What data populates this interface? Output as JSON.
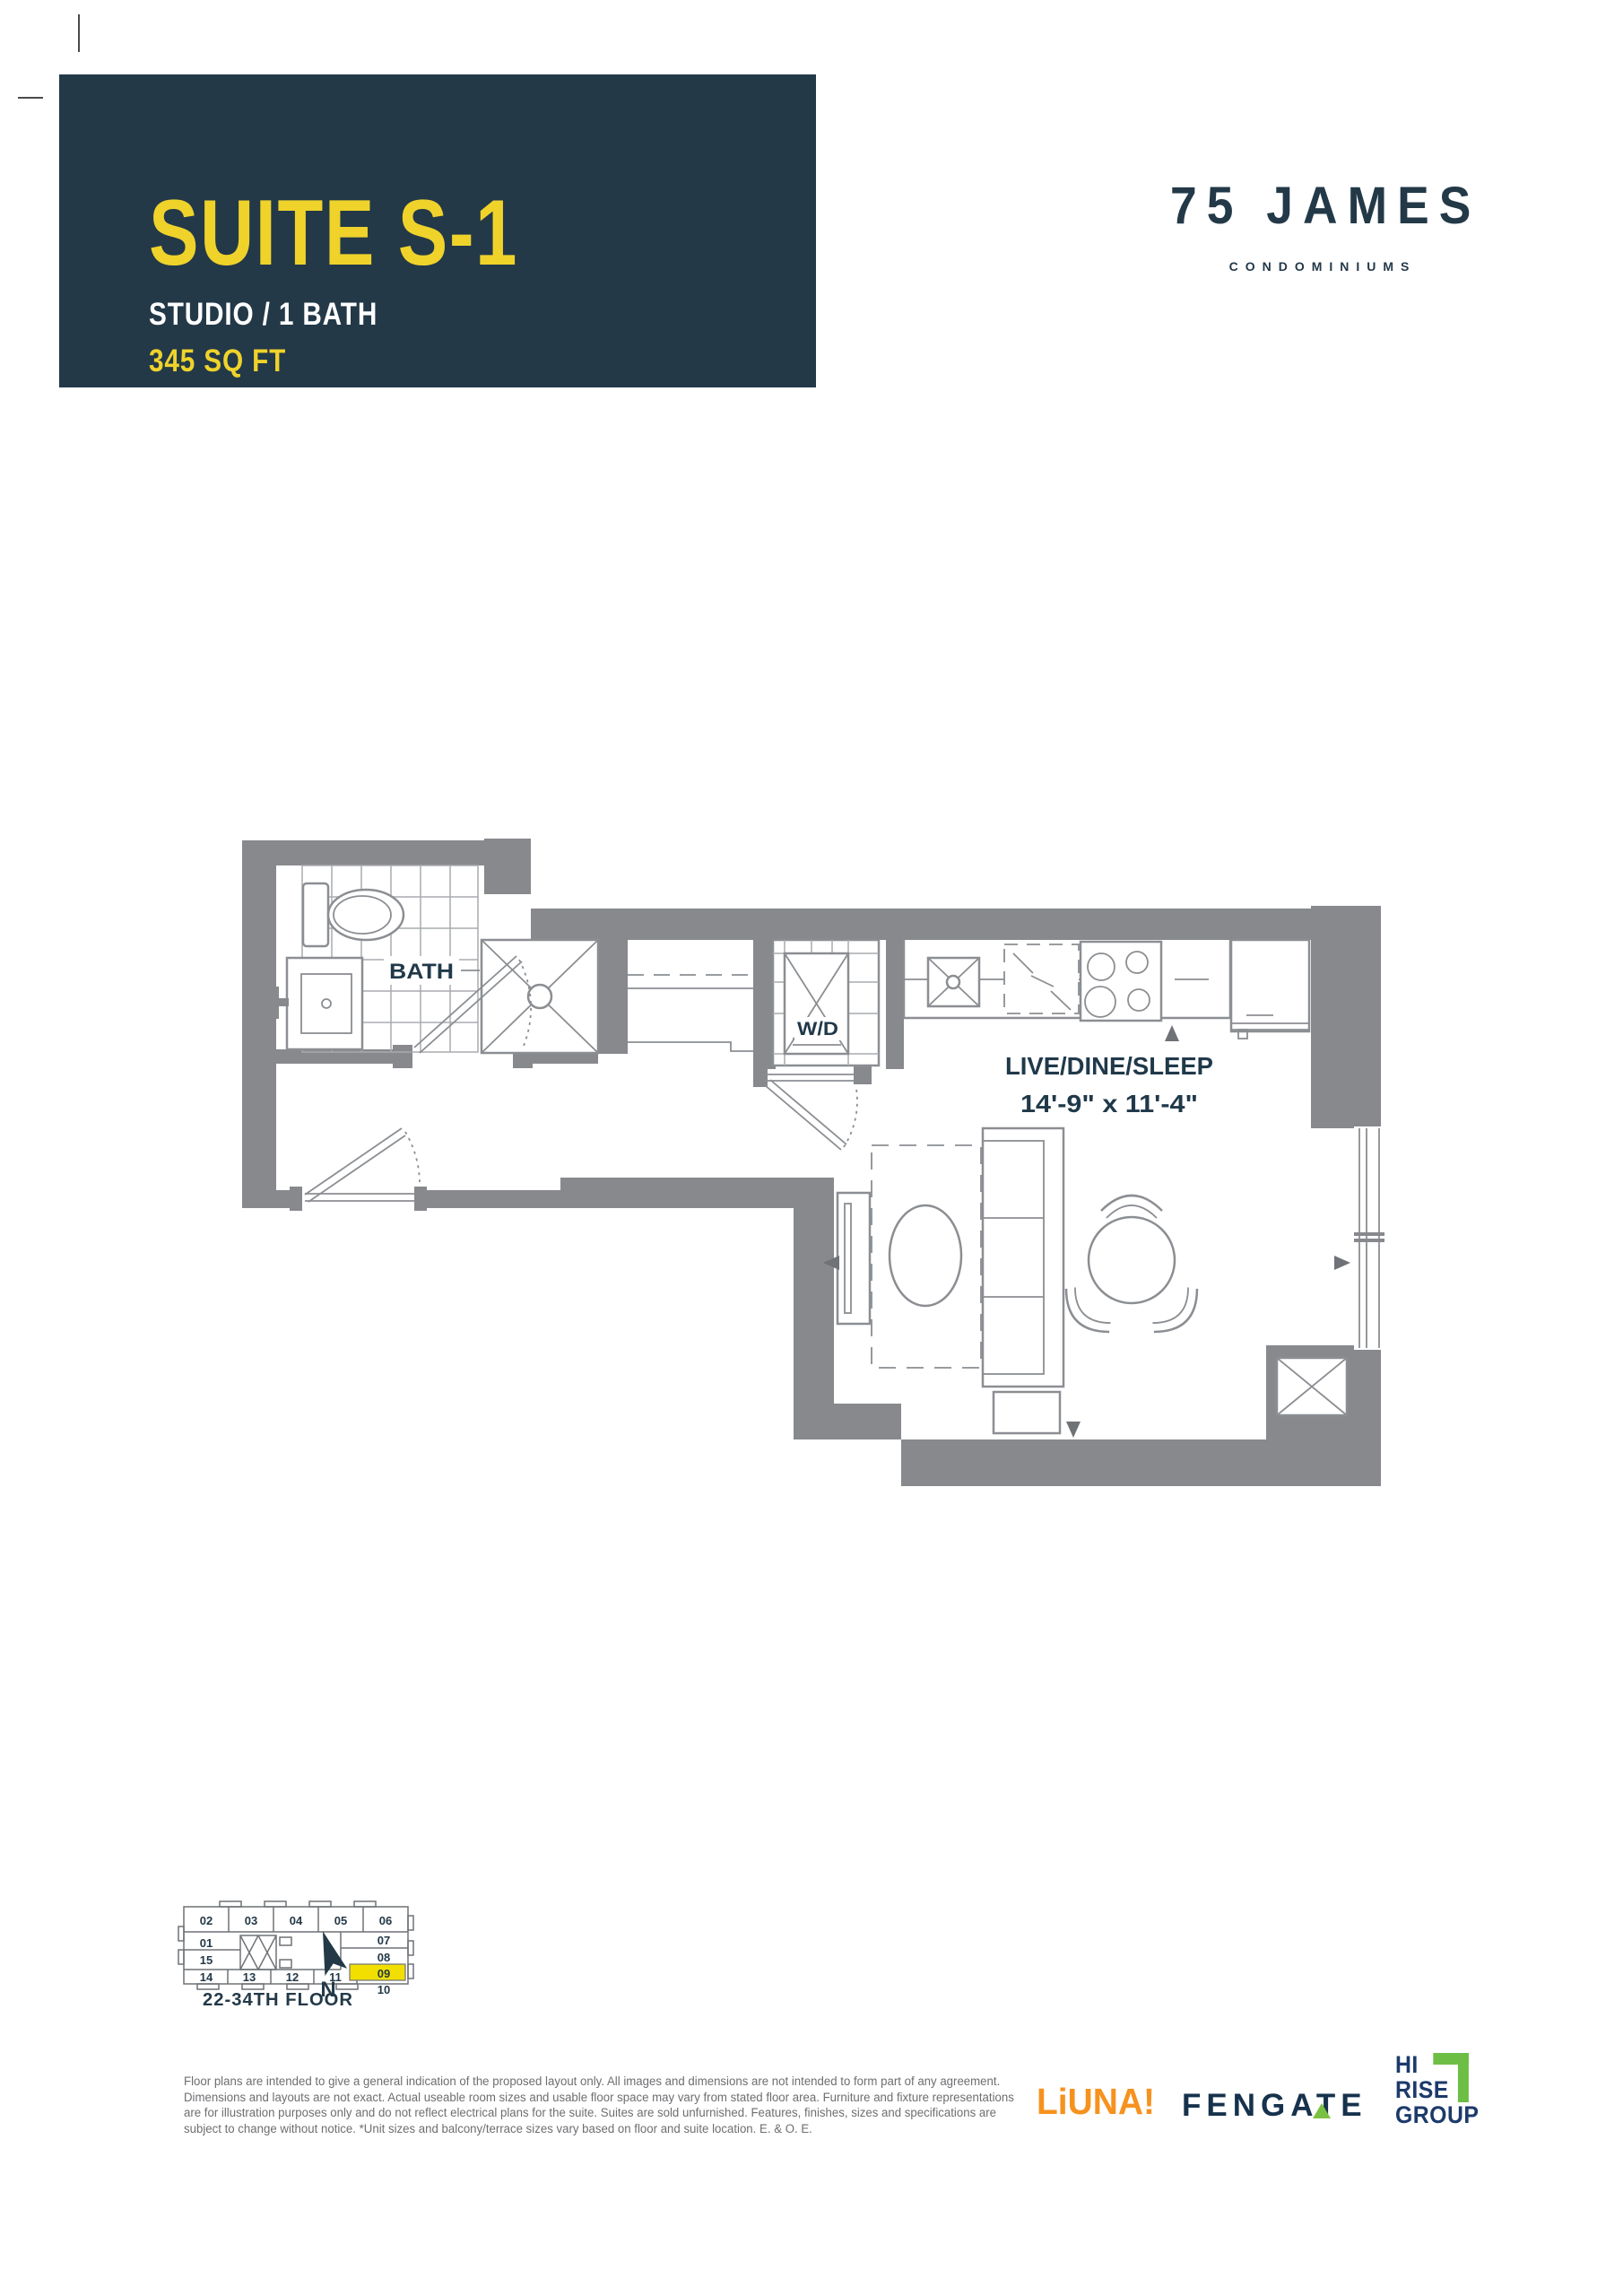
{
  "header": {
    "suite": "SUITE S-1",
    "type": "STUDIO / 1 BATH",
    "area": "345 SQ FT"
  },
  "brand": {
    "name": "75 JAMES",
    "sub": "CONDOMINIUMS"
  },
  "plan": {
    "labels": {
      "bath": "BATH",
      "wd": "W/D",
      "living": "LIVE/DINE/SLEEP",
      "dims": "14'-9\" x 11'-4\""
    }
  },
  "keyplan": {
    "floor_label": "22-34TH FLOOR",
    "north_label": "N",
    "highlight_unit": "09",
    "units_top": [
      "02",
      "03",
      "04",
      "05",
      "06"
    ],
    "units_left": [
      "01",
      "15"
    ],
    "units_right": [
      "07",
      "08",
      "09"
    ],
    "units_bottom": [
      "14",
      "13",
      "12",
      "11",
      "10"
    ]
  },
  "disclaimer": {
    "lines": [
      "Floor plans are intended to give a general indication of the proposed layout only. All images and dimensions are not intended to form part of any agreement.",
      "Dimensions and layouts are not exact. Actual useable room sizes and usable floor space may vary from stated floor area. Furniture and fixture representations",
      "are for illustration purposes only and do not reflect electrical plans for the suite. Suites are sold unfurnished. Features, finishes, sizes and specifications are",
      "subject to change without notice. *Unit sizes and balcony/terrace sizes vary based on floor and suite location. E. & O. E."
    ]
  },
  "partners": {
    "liuna": "LiUNA!",
    "fengate": "FENGATE",
    "hirise": [
      "HI",
      "RISE",
      "GROUP"
    ]
  },
  "colors": {
    "header_bg": "#233948",
    "accent_yellow": "#EFD32B",
    "wall_gray": "#87898D",
    "plan_text_navy": "#20394A",
    "keyplan_highlight": "#F2DF00",
    "liuna_orange": "#F6921E",
    "fengate_navy": "#16324C",
    "fengate_green": "#7AC143",
    "hirise_navy": "#1C3A6B",
    "hirise_green": "#6CBE45",
    "disclaimer_gray": "#6D6E71"
  }
}
